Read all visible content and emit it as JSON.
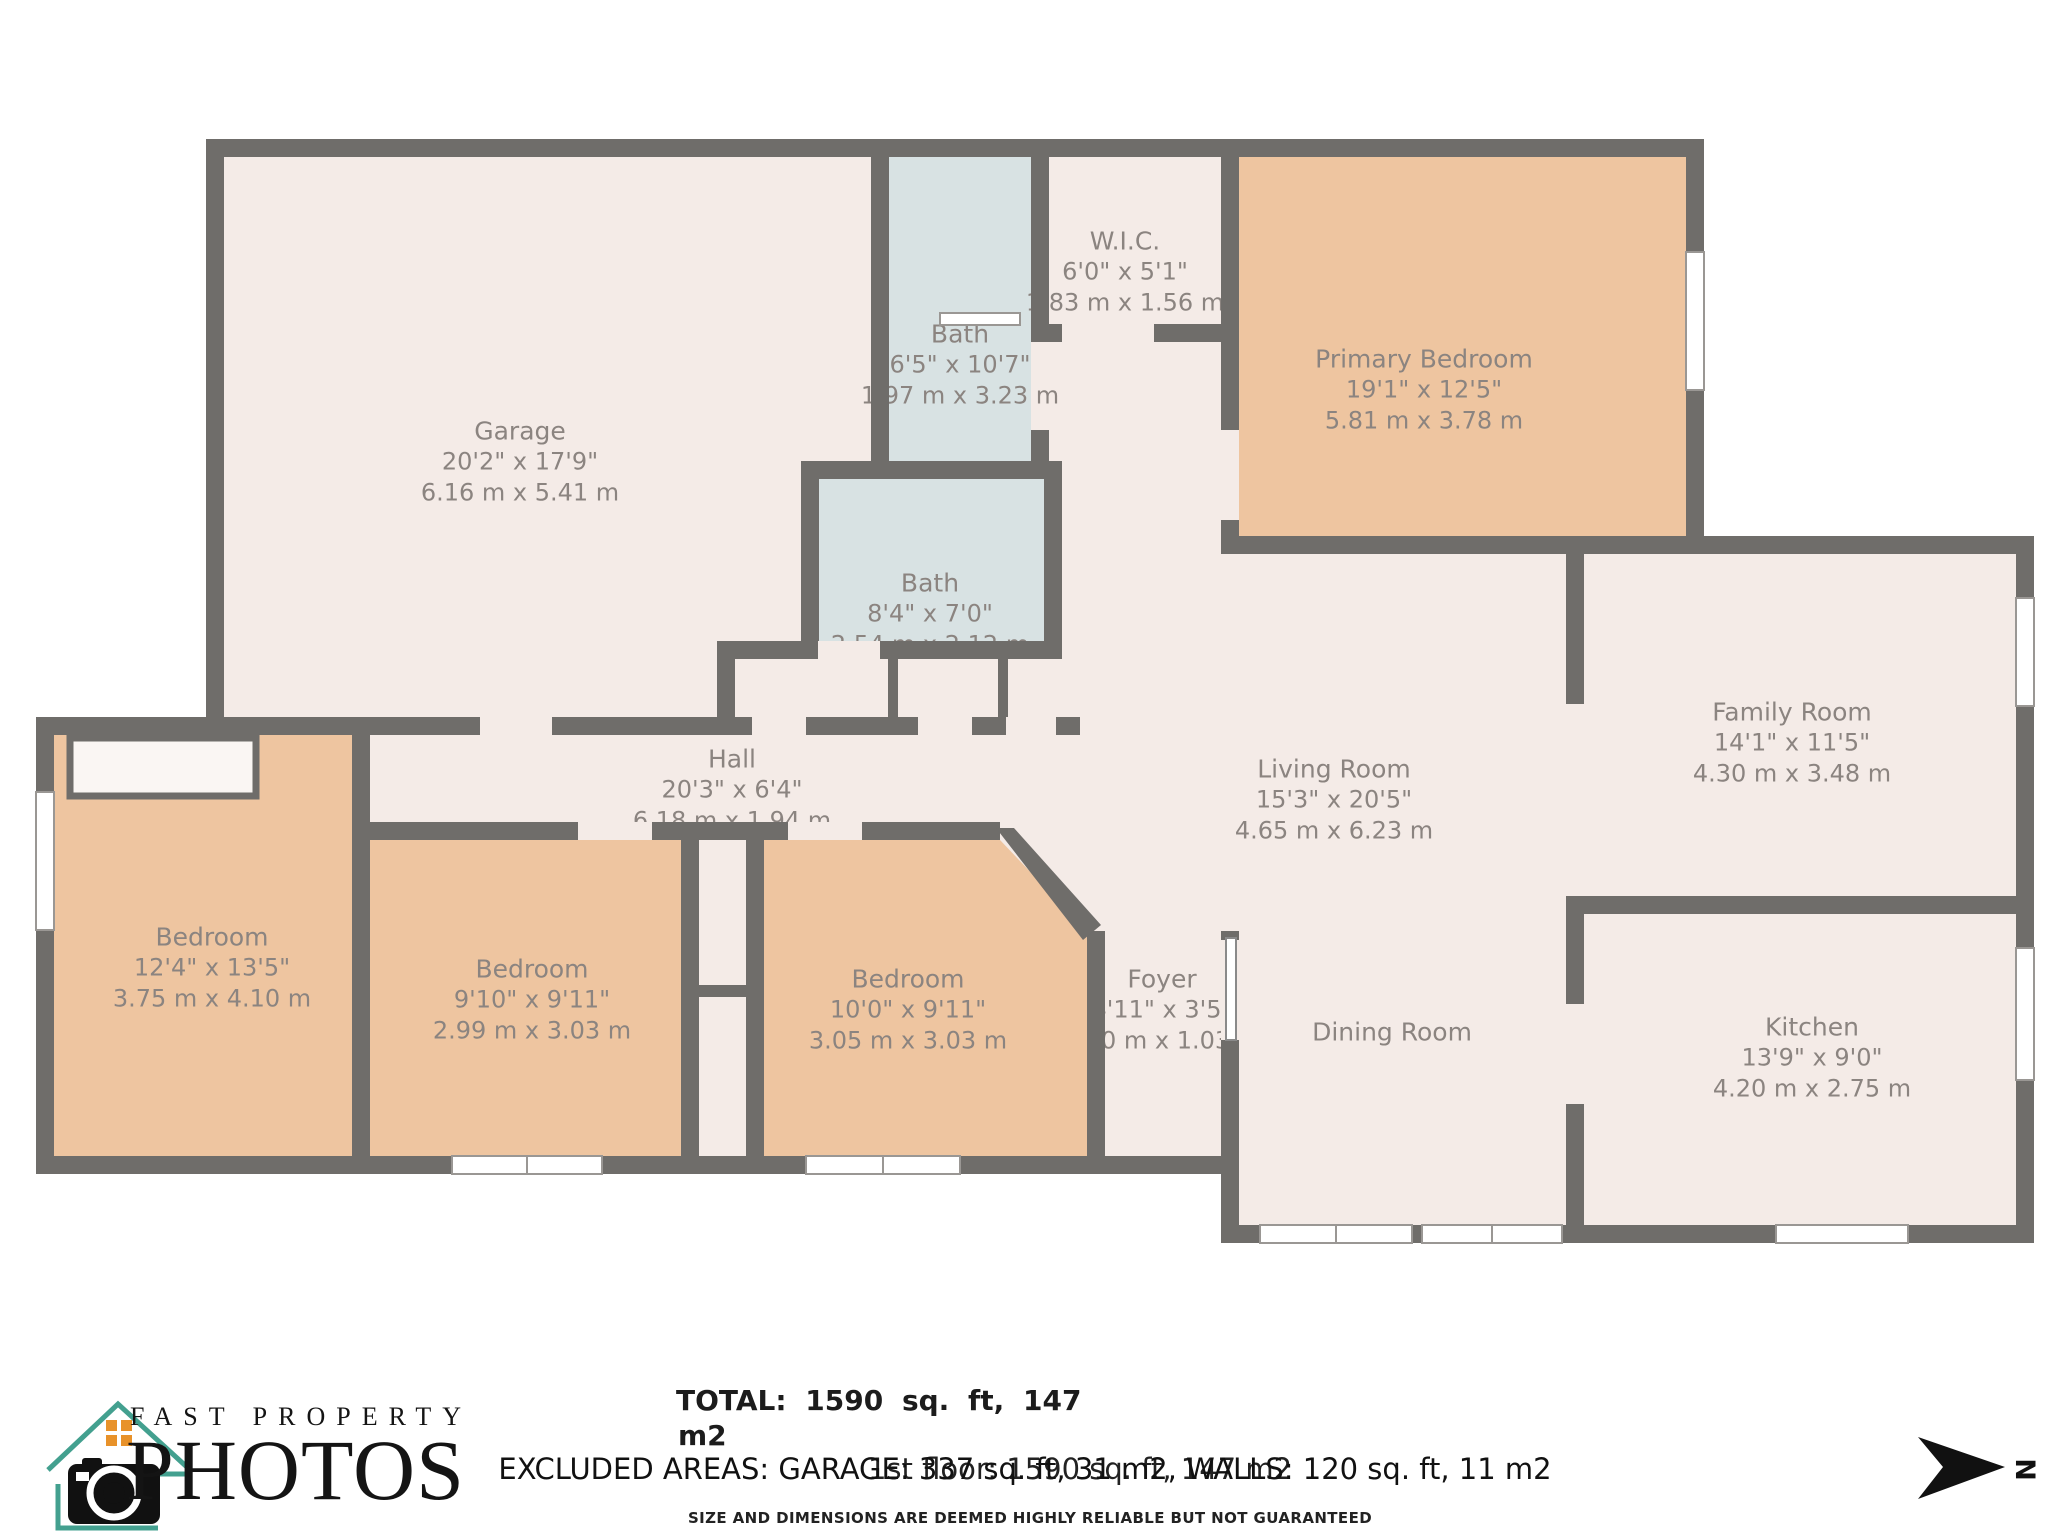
{
  "plan": {
    "rooms": [
      {
        "id": "garage",
        "name": "Garage",
        "imperial": "20'2\" x 17'9\"",
        "metric": "6.16 m x 5.41 m"
      },
      {
        "id": "bath-upper",
        "name": "Bath",
        "imperial": "6'5\" x 10'7\"",
        "metric": "1.97 m x 3.23 m"
      },
      {
        "id": "wic",
        "name": "W.I.C.",
        "imperial": "6'0\" x 5'1\"",
        "metric": "1.83 m x 1.56 m"
      },
      {
        "id": "primary-bedroom",
        "name": "Primary Bedroom",
        "imperial": "19'1\" x 12'5\"",
        "metric": "5.81 m x 3.78 m"
      },
      {
        "id": "bath-lower",
        "name": "Bath",
        "imperial": "8'4\" x 7'0\"",
        "metric": "2.54 m x 2.12 m"
      },
      {
        "id": "hall",
        "name": "Hall",
        "imperial": "20'3\" x 6'4\"",
        "metric": "6.18 m x 1.94 m"
      },
      {
        "id": "living-room",
        "name": "Living Room",
        "imperial": "15'3\" x 20'5\"",
        "metric": "4.65 m x 6.23 m"
      },
      {
        "id": "family-room",
        "name": "Family Room",
        "imperial": "14'1\" x 11'5\"",
        "metric": "4.30 m x 3.48 m"
      },
      {
        "id": "bedroom-1",
        "name": "Bedroom",
        "imperial": "12'4\" x 13'5\"",
        "metric": "3.75 m x 4.10 m"
      },
      {
        "id": "bedroom-2",
        "name": "Bedroom",
        "imperial": "9'10\" x 9'11\"",
        "metric": "2.99 m x 3.03 m"
      },
      {
        "id": "bedroom-3",
        "name": "Bedroom",
        "imperial": "10'0\" x 9'11\"",
        "metric": "3.05 m x 3.03 m"
      },
      {
        "id": "foyer",
        "name": "Foyer",
        "imperial": "4'11\" x 3'5\"",
        "metric": "1.50 m x 1.03 m"
      },
      {
        "id": "dining-room",
        "name": "Dining Room"
      },
      {
        "id": "kitchen",
        "name": "Kitchen",
        "imperial": "13'9\" x 9'0\"",
        "metric": "4.20 m x 2.75 m"
      }
    ],
    "colors": {
      "wall": "#6f6d6a",
      "floor": "#f4ebe7",
      "bedroom_floor": "#eec5a0",
      "bath_floor": "#d8e2e3",
      "label_text": "#8b8480"
    }
  },
  "footer": {
    "total_line1": "TOTAL: 1590 sq. ft, 147",
    "total_line2": "m2",
    "floor_total": "1st floor: 1590 sq. ft, 147 m2",
    "excluded": "EXCLUDED AREAS: GARAGE: 337 sq. ft, 31 m2, WALLS: 120 sq. ft, 11 m2",
    "disclaimer": "SIZE AND DIMENSIONS ARE DEEMED HIGHLY RELIABLE BUT NOT GUARANTEED"
  },
  "logo": {
    "line1": "FAST PROPERTY",
    "line2": "PHOTOS",
    "accent_teal": "#43a08f",
    "accent_orange": "#e8922a"
  },
  "compass": {
    "label": "N"
  }
}
